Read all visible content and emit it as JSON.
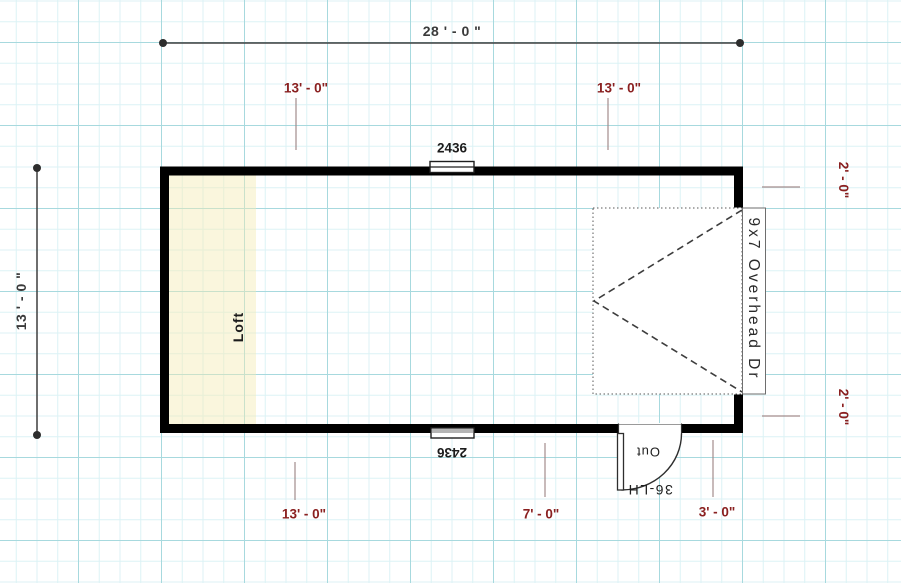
{
  "dims": {
    "top_total": "28 ' - 0 \"",
    "left_total": "13 ' - 0 \"",
    "spans": {
      "top_left": "13' - 0\"",
      "top_right": "13' - 0\"",
      "right_top": "2' - 0\"",
      "right_bottom": "2' - 0\"",
      "bottom_left": "13' - 0\"",
      "bottom_mid": "7' - 0\"",
      "bottom_right": "3' - 0\""
    }
  },
  "objects": {
    "loft": "Loft",
    "window_top": "2436",
    "window_bottom": "2436",
    "overhead_door": "9x7 Overhead Dr",
    "entry_door": "36-LH",
    "entry_door_swing": "Out"
  },
  "colors": {
    "wall": "#000000",
    "dimension_text": "#3a3a3a",
    "span_text": "#8a2020",
    "tick_line": "#a28c8c",
    "loft_fill": "#f8f3cd",
    "grid_minor": "#dcf2f5",
    "grid_major": "#a7d9de",
    "paper": "#ffffff"
  }
}
